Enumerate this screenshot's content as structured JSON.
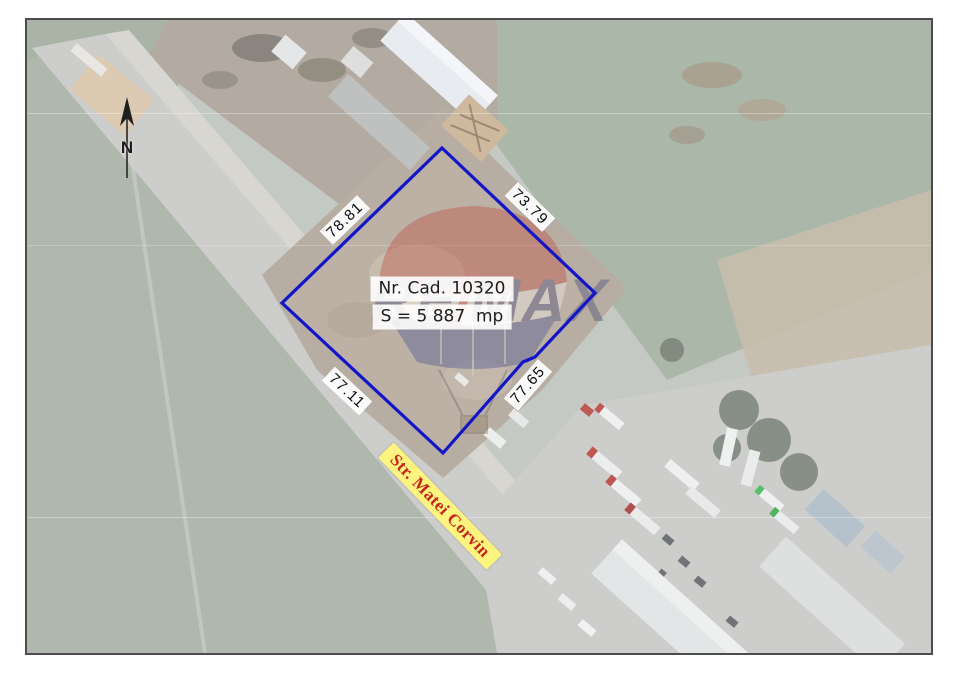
{
  "map": {
    "frame": {
      "border_color": "#4c4c4c",
      "margin_bg": "#ffffff"
    },
    "parcel": {
      "outline_color": "#1216c8",
      "cad_label": "Nr. Cad. 10320",
      "area_label": "S = 5 887  mp",
      "side_lengths": [
        {
          "side": "northwest",
          "value": "78.81"
        },
        {
          "side": "northeast",
          "value": "73.79"
        },
        {
          "side": "southeast",
          "value": "77.65"
        },
        {
          "side": "southwest",
          "value": "77.11"
        }
      ]
    },
    "street_label": {
      "text": "Str. Matei Corvin",
      "bg_color": "#fcf47e",
      "text_color": "#c4261d"
    },
    "north_indicator": {
      "label": "N"
    },
    "watermark": {
      "part_re": "RE",
      "part_slash": "/",
      "part_max": "MAX",
      "text_color": "#2b3570",
      "slash_color": "#d5392e"
    }
  }
}
